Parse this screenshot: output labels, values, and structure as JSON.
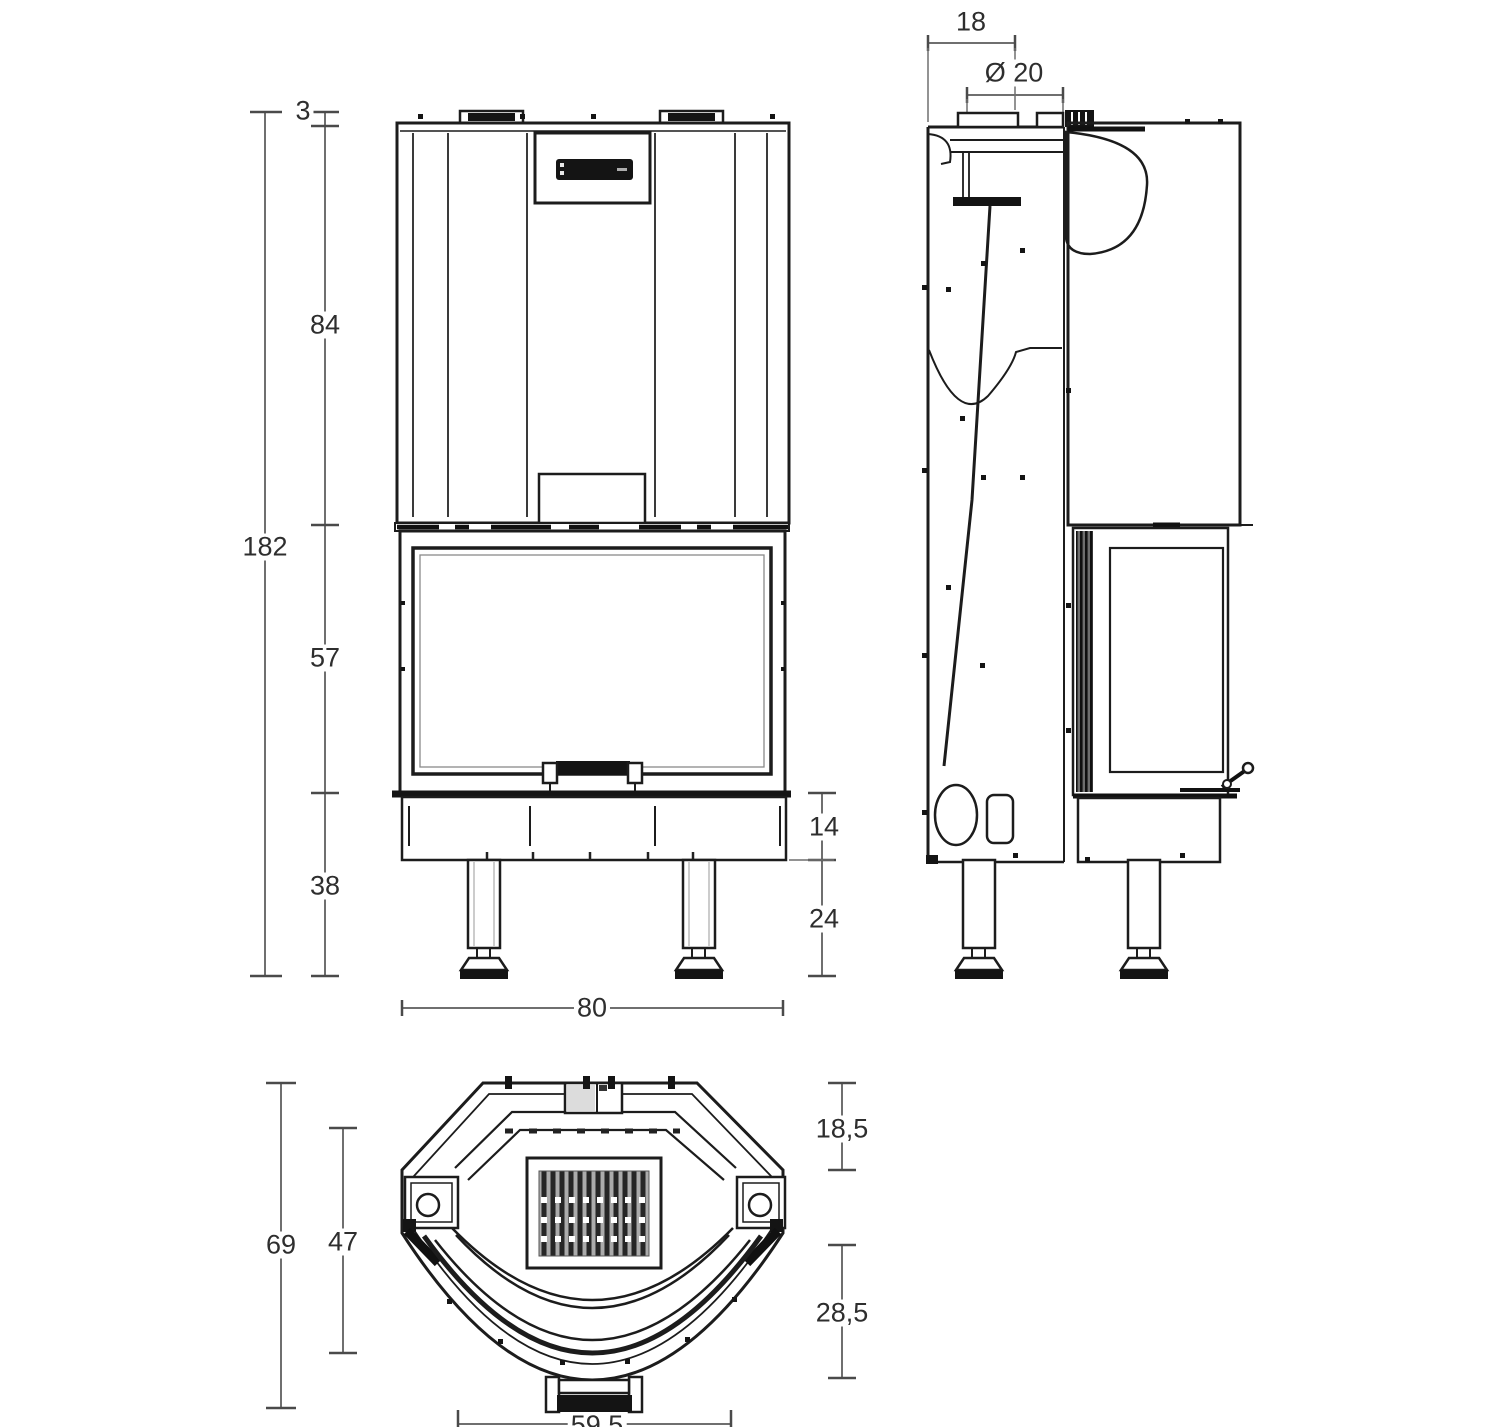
{
  "views": {
    "front": {
      "dims": {
        "top_offset": "3",
        "hood_height": "84",
        "total_height": "182",
        "door_height": "57",
        "base_height": "38",
        "plinth_height": "14",
        "leg_height": "24",
        "width": "80"
      }
    },
    "side": {
      "dims": {
        "top_depth": "18",
        "flue_diameter": "Ø 20"
      }
    },
    "plan": {
      "dims": {
        "total_depth": "69",
        "inner_depth": "47",
        "rear_offset": "18,5",
        "front_offset": "28,5",
        "front_width": "59,5"
      }
    }
  },
  "colors": {
    "background": "#ffffff",
    "drawing_line": "#1c1c1c",
    "dimension_line": "#6f6f6f",
    "text": "#2e2e2e"
  }
}
